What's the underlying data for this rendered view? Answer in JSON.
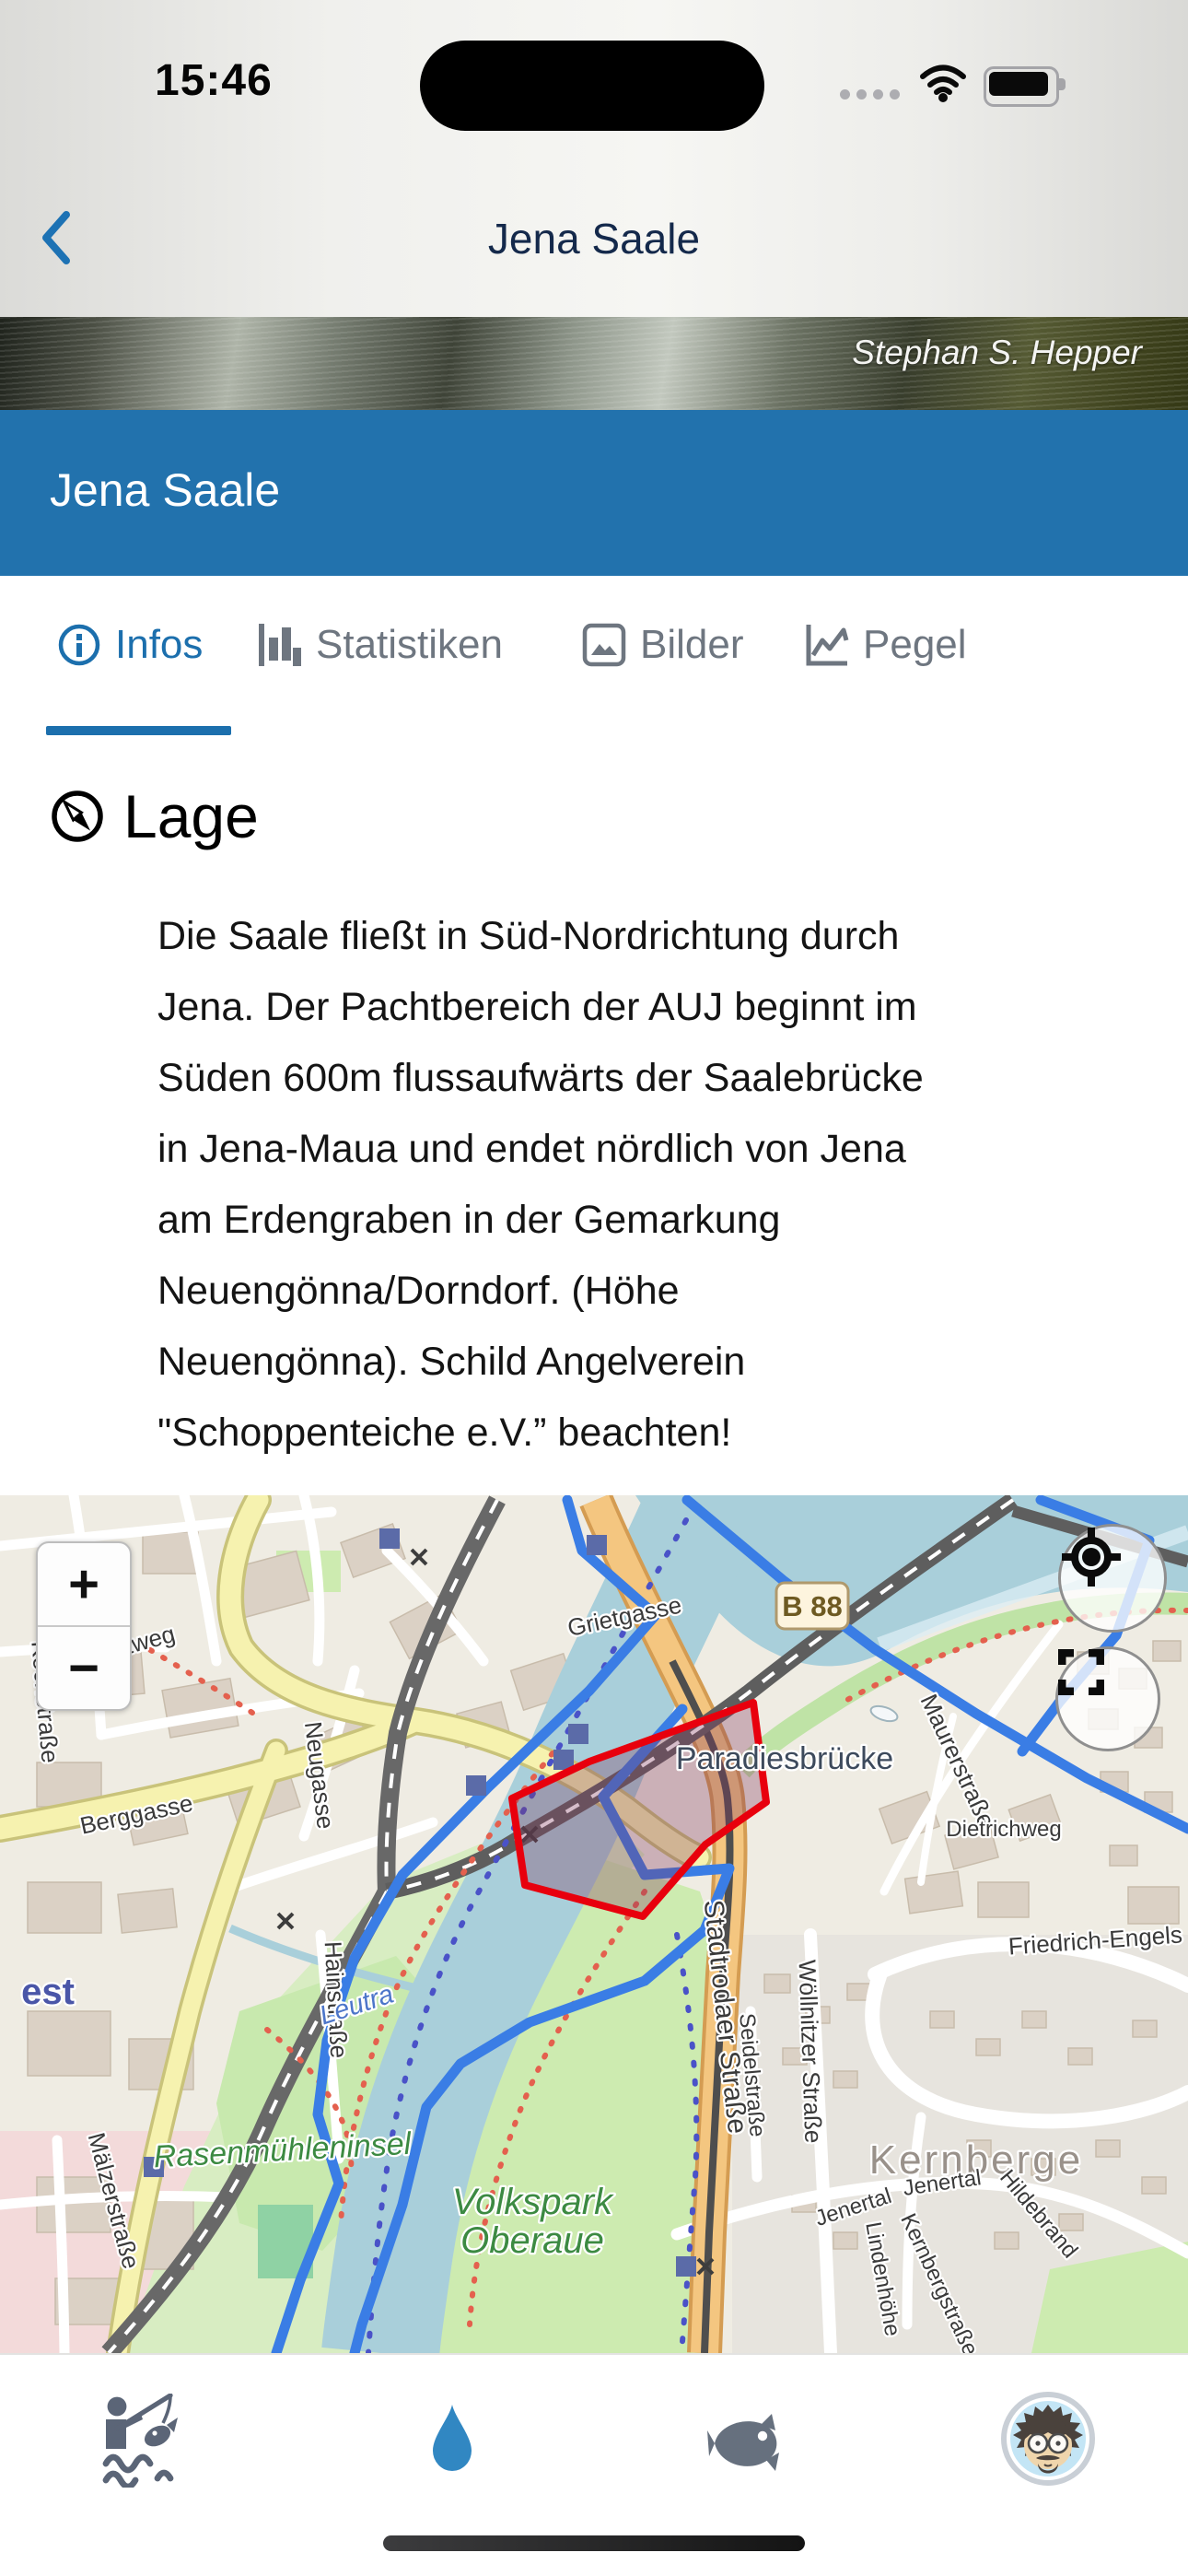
{
  "status_bar": {
    "time": "15:46"
  },
  "nav_bar": {
    "title": "Jena Saale"
  },
  "hero": {
    "photo_credit": "Stephan S. Hepper"
  },
  "banner": {
    "title": "Jena Saale"
  },
  "tabs": [
    {
      "label": "Infos",
      "active": true
    },
    {
      "label": "Statistiken",
      "active": false
    },
    {
      "label": "Bilder",
      "active": false
    },
    {
      "label": "Pegel",
      "active": false
    }
  ],
  "section": {
    "title": "Lage",
    "body": "Die Saale fließt in Süd-Nordrichtung durch\nJena. Der Pachtbereich der AUJ beginnt im\nSüden 600m flussaufwärts der Saalebrücke\nin Jena-Maua und endet nördlich von Jena\nam Erdengraben in der Gemarkung\nNeuengönna/Dorndorf. (Höhe\nNeuengönna). Schild Angelverein\n\"Schoppenteiche e.V.” beachten!"
  },
  "map": {
    "zoom_in": "+",
    "zoom_out": "−",
    "road_badge": "B 88",
    "labels": [
      "Grietgasse",
      "Forstweg",
      "Kochstraße",
      "Berggasse",
      "Neugasse",
      "Paradiesbrücke",
      "Maurerstraße",
      "Dietrichweg",
      "Friedrich-Engels",
      "est",
      "Hainstraße",
      "Mälzerstraße",
      "Leutra",
      "Rasenmühleninsel",
      "Volkspark",
      "Oberaue",
      "Stadtrodaer Straße",
      "Seidelstraße",
      "Wöllnitzer Straße",
      "Kernberge",
      "Jenertal",
      "Jenertal",
      "Lindenhöhe",
      "Kernbergstraße",
      "Hildebrand"
    ],
    "highlight_color": "#E8000D",
    "route_color": "#3A7DE5"
  },
  "bottom_nav": {
    "items": [
      {
        "name": "angler",
        "active": false
      },
      {
        "name": "waters",
        "active": true
      },
      {
        "name": "fish",
        "active": false
      },
      {
        "name": "profile",
        "active": false
      }
    ],
    "active_color": "#3187C2",
    "inactive_color": "#5B6577"
  }
}
